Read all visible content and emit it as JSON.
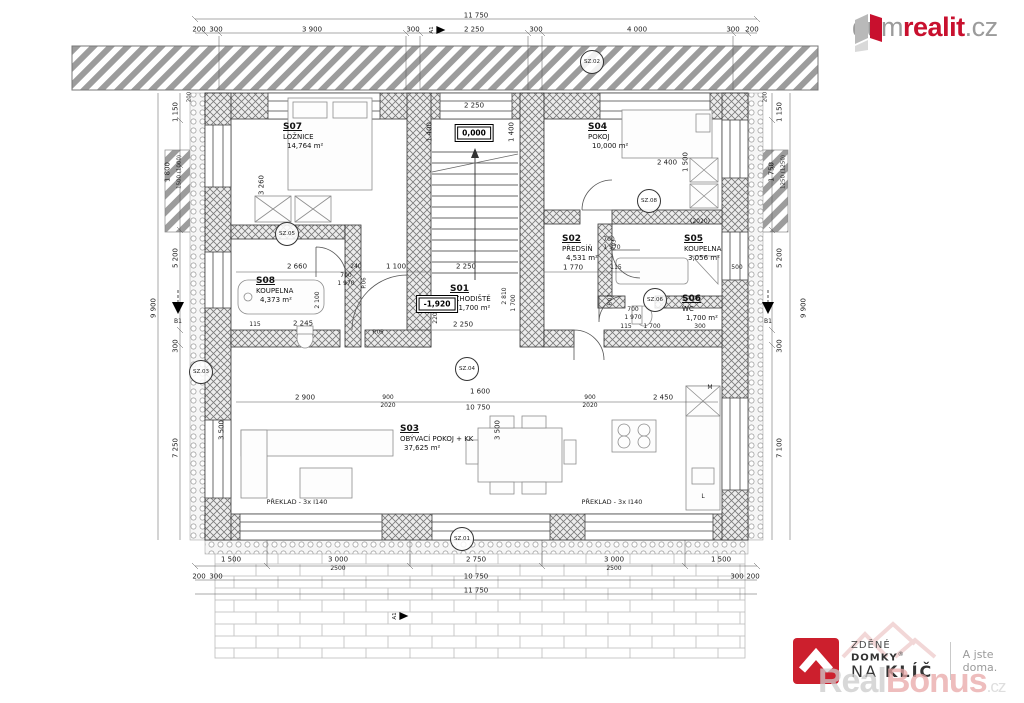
{
  "branding": {
    "dumrealit": {
      "prefix": "dum",
      "accent": "realit",
      "suffix": ".cz"
    },
    "naklic": {
      "line1_a": "ZDĚNÉ ",
      "line1_b": "DOMKY",
      "reg": "®",
      "line2_a": "NA ",
      "line2_b": "KLÍČ",
      "tagline": "A jste doma."
    },
    "realbonus": {
      "a": "Real",
      "b": "Bonus",
      "c": ".cz"
    }
  },
  "colors": {
    "brand_red": "#c8102e",
    "logo_gray": "#9b9b9b",
    "wall": "#777777"
  },
  "plan": {
    "rooms": [
      {
        "id": "S07",
        "name": "LOŽNICE",
        "area": "14,764 m²",
        "x": 283,
        "y": 122
      },
      {
        "id": "S04",
        "name": "POKOJ",
        "area": "10,000 m²",
        "x": 588,
        "y": 122
      },
      {
        "id": "S02",
        "name": "PŘEDSÍŇ",
        "area": "4,531 m²",
        "x": 562,
        "y": 234
      },
      {
        "id": "S05",
        "name": "KOUPELNA",
        "area": "3,056 m²",
        "x": 684,
        "y": 234
      },
      {
        "id": "S08",
        "name": "KOUPELNA",
        "area": "4,373 m²",
        "x": 256,
        "y": 276
      },
      {
        "id": "S01",
        "name": "SCHODIŠTĚ",
        "area": "11,700 m²",
        "x": 450,
        "y": 284
      },
      {
        "id": "S06",
        "name": "WC",
        "area": "1,700 m²",
        "x": 682,
        "y": 294
      },
      {
        "id": "S03",
        "name": "OBÝVACÍ POKOJ + KK",
        "area": "37,625 m²",
        "x": 400,
        "y": 424
      }
    ],
    "levels": [
      {
        "t": "0,000",
        "x": 474,
        "y": 133
      },
      {
        "t": "-1,920",
        "x": 437,
        "y": 304
      }
    ],
    "markers": [
      {
        "t": "SZ.01",
        "x": 462,
        "y": 539
      },
      {
        "t": "SZ.02",
        "x": 592,
        "y": 62
      },
      {
        "t": "SZ.03",
        "x": 201,
        "y": 372
      },
      {
        "t": "SZ.04",
        "x": 467,
        "y": 369
      },
      {
        "t": "SZ.05",
        "x": 287,
        "y": 234
      },
      {
        "t": "SZ.06",
        "x": 655,
        "y": 300
      },
      {
        "t": "SZ.08",
        "x": 649,
        "y": 201
      }
    ],
    "flags": [
      {
        "t": "A1",
        "x": 437,
        "y": 30
      },
      {
        "t": "A1",
        "x": 400,
        "y": 616
      }
    ],
    "dims": [
      {
        "t": "11 750",
        "x": 476,
        "y": 16
      },
      {
        "t": "200",
        "x": 199,
        "y": 30
      },
      {
        "t": "300",
        "x": 216,
        "y": 30
      },
      {
        "t": "3 900",
        "x": 312,
        "y": 30
      },
      {
        "t": "300",
        "x": 413,
        "y": 30
      },
      {
        "t": "2 250",
        "x": 474,
        "y": 30
      },
      {
        "t": "300",
        "x": 536,
        "y": 30
      },
      {
        "t": "4 000",
        "x": 637,
        "y": 30
      },
      {
        "t": "300",
        "x": 733,
        "y": 30
      },
      {
        "t": "200",
        "x": 752,
        "y": 30
      },
      {
        "t": "1 500",
        "x": 231,
        "y": 560
      },
      {
        "t": "3 000",
        "x": 338,
        "y": 560
      },
      {
        "t": "2500",
        "x": 338,
        "y": 569,
        "s": 6
      },
      {
        "t": "2 750",
        "x": 476,
        "y": 560
      },
      {
        "t": "3 000",
        "x": 614,
        "y": 560
      },
      {
        "t": "2500",
        "x": 614,
        "y": 569,
        "s": 6
      },
      {
        "t": "1 500",
        "x": 721,
        "y": 560
      },
      {
        "t": "200",
        "x": 199,
        "y": 577
      },
      {
        "t": "300",
        "x": 216,
        "y": 577
      },
      {
        "t": "10 750",
        "x": 476,
        "y": 577
      },
      {
        "t": "300",
        "x": 737,
        "y": 577
      },
      {
        "t": "200",
        "x": 753,
        "y": 577
      },
      {
        "t": "11 750",
        "x": 476,
        "y": 591
      },
      {
        "t": "1 150",
        "x": 176,
        "y": 112,
        "r": 1
      },
      {
        "t": "1 800",
        "x": 168,
        "y": 172,
        "r": 1
      },
      {
        "t": "1500 (1000)",
        "x": 180,
        "y": 172,
        "r": 1,
        "s": 5.5
      },
      {
        "t": "5 200",
        "x": 176,
        "y": 258,
        "r": 1
      },
      {
        "t": "9 900",
        "x": 154,
        "y": 308,
        "r": 1
      },
      {
        "t": "300",
        "x": 176,
        "y": 346,
        "r": 1
      },
      {
        "t": "7 250",
        "x": 176,
        "y": 448,
        "r": 1
      },
      {
        "t": "200",
        "x": 190,
        "y": 97,
        "r": 1,
        "s": 5.5
      },
      {
        "t": "3 500",
        "x": 222,
        "y": 430,
        "r": 1
      },
      {
        "t": "1 150",
        "x": 780,
        "y": 112,
        "r": 1
      },
      {
        "t": "1 750",
        "x": 772,
        "y": 172,
        "r": 1
      },
      {
        "t": "1250 (1250)",
        "x": 784,
        "y": 172,
        "r": 1,
        "s": 5.5
      },
      {
        "t": "5 200",
        "x": 780,
        "y": 258,
        "r": 1
      },
      {
        "t": "9 900",
        "x": 804,
        "y": 308,
        "r": 1
      },
      {
        "t": "300",
        "x": 780,
        "y": 346,
        "r": 1
      },
      {
        "t": "7 100",
        "x": 780,
        "y": 448,
        "r": 1
      },
      {
        "t": "200",
        "x": 766,
        "y": 97,
        "r": 1,
        "s": 5.5
      },
      {
        "t": "2 250",
        "x": 474,
        "y": 106
      },
      {
        "t": "1 400",
        "x": 430,
        "y": 132,
        "r": 1
      },
      {
        "t": "1 400",
        "x": 512,
        "y": 132,
        "r": 1
      },
      {
        "t": "3 260",
        "x": 262,
        "y": 185,
        "r": 1
      },
      {
        "t": "2 400",
        "x": 667,
        "y": 163
      },
      {
        "t": "1 500",
        "x": 686,
        "y": 162,
        "r": 1
      },
      {
        "t": "2 660",
        "x": 297,
        "y": 267
      },
      {
        "t": "240",
        "x": 356,
        "y": 267,
        "s": 6
      },
      {
        "t": "1 100",
        "x": 396,
        "y": 267
      },
      {
        "t": "2 250",
        "x": 466,
        "y": 267
      },
      {
        "t": "700",
        "x": 346,
        "y": 276,
        "s": 6
      },
      {
        "t": "1 970",
        "x": 346,
        "y": 284,
        "s": 6
      },
      {
        "t": "700",
        "x": 609,
        "y": 240,
        "s": 6
      },
      {
        "t": "1 970",
        "x": 612,
        "y": 248,
        "s": 6
      },
      {
        "t": "1 770",
        "x": 573,
        "y": 268
      },
      {
        "t": "115",
        "x": 616,
        "y": 268,
        "s": 6
      },
      {
        "t": "(2020)",
        "x": 700,
        "y": 222,
        "s": 6
      },
      {
        "t": "2 245",
        "x": 303,
        "y": 324
      },
      {
        "t": "115",
        "x": 255,
        "y": 325,
        "s": 6
      },
      {
        "t": "2 100",
        "x": 318,
        "y": 300,
        "r": 1,
        "s": 6
      },
      {
        "t": "2 250",
        "x": 463,
        "y": 325
      },
      {
        "t": "220",
        "x": 436,
        "y": 318,
        "r": 1,
        "s": 6
      },
      {
        "t": "2 810",
        "x": 505,
        "y": 296,
        "r": 1,
        "s": 6
      },
      {
        "t": "1 700",
        "x": 514,
        "y": 303,
        "r": 1,
        "s": 6
      },
      {
        "t": "700",
        "x": 633,
        "y": 310,
        "s": 6
      },
      {
        "t": "1 970",
        "x": 633,
        "y": 318,
        "s": 6
      },
      {
        "t": "115",
        "x": 626,
        "y": 327,
        "s": 6
      },
      {
        "t": "1 700",
        "x": 652,
        "y": 327,
        "s": 6
      },
      {
        "t": "300",
        "x": 700,
        "y": 327,
        "s": 6
      },
      {
        "t": "500",
        "x": 737,
        "y": 268,
        "s": 6
      },
      {
        "t": "2 900",
        "x": 305,
        "y": 398
      },
      {
        "t": "900",
        "x": 388,
        "y": 398,
        "s": 6
      },
      {
        "t": "2020",
        "x": 388,
        "y": 406,
        "s": 6
      },
      {
        "t": "1 600",
        "x": 480,
        "y": 392
      },
      {
        "t": "10 750",
        "x": 478,
        "y": 408
      },
      {
        "t": "900",
        "x": 590,
        "y": 398,
        "s": 6
      },
      {
        "t": "2020",
        "x": 590,
        "y": 406,
        "s": 6
      },
      {
        "t": "2 450",
        "x": 663,
        "y": 398
      },
      {
        "t": "3 500",
        "x": 498,
        "y": 430,
        "r": 1
      },
      {
        "t": "M",
        "x": 710,
        "y": 388,
        "s": 6
      },
      {
        "t": "L",
        "x": 703,
        "y": 497,
        "s": 6
      },
      {
        "t": "P.05",
        "x": 378,
        "y": 333,
        "s": 5.5
      },
      {
        "t": "P.06",
        "x": 365,
        "y": 283,
        "r": 1,
        "s": 5.5
      },
      {
        "t": "P.03",
        "x": 615,
        "y": 245,
        "r": 1,
        "s": 5.5
      },
      {
        "t": "P.07",
        "x": 611,
        "y": 300,
        "r": 1,
        "s": 5.5
      },
      {
        "t": "B1",
        "x": 178,
        "y": 322,
        "s": 6
      },
      {
        "t": "B1",
        "x": 768,
        "y": 322,
        "s": 6
      },
      {
        "t": "PŘEKLAD - 3x I140",
        "x": 297,
        "y": 502,
        "s": 6.5
      },
      {
        "t": "PŘEKLAD - 3x I140",
        "x": 612,
        "y": 502,
        "s": 6.5
      }
    ]
  }
}
